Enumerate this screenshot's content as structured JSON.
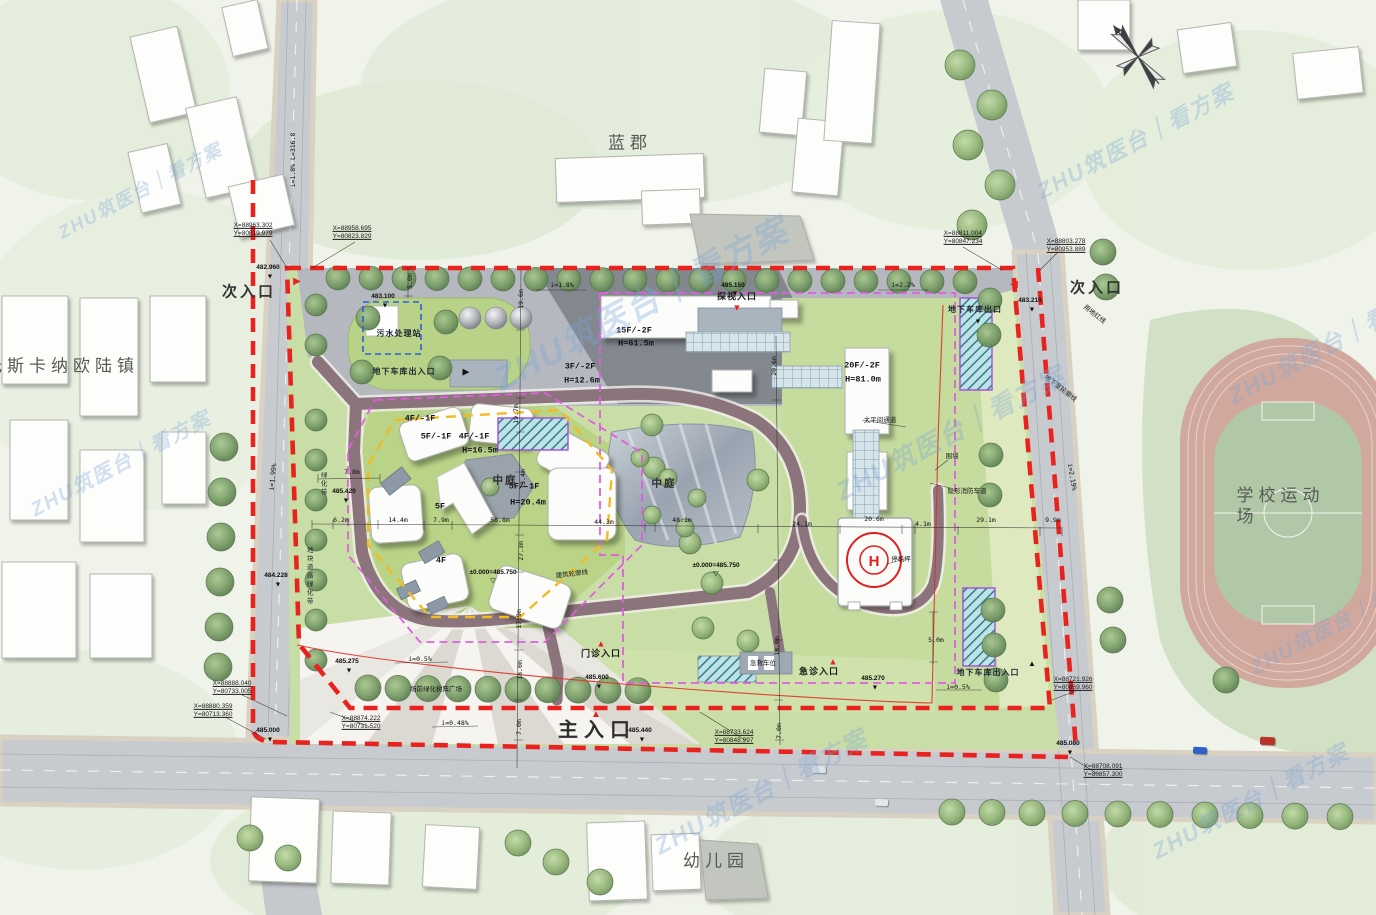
{
  "plan_title": "医院总平面图",
  "colors": {
    "red_line": "#e8231f",
    "magenta_line": "#df5fdf",
    "yellow_line": "#f2bb22",
    "blue_line": "#2b5fd9",
    "road": "#c7cace",
    "lawn": "#c9dda6",
    "ring_road": "#8b747b",
    "track": "#d0a89e",
    "helipad_mark": "#e02020",
    "watermark": "#76a6d6"
  },
  "watermark": {
    "text": "ZHU筑医台｜看方案"
  },
  "north_arrow": {
    "present": true
  },
  "labels": [
    {
      "n": "district-lanjun",
      "t": "蓝郡",
      "x": 630,
      "y": 143,
      "c": "area"
    },
    {
      "n": "district-tuscany",
      "t": "托斯卡纳欧陆镇",
      "x": 62,
      "y": 366,
      "c": "area"
    },
    {
      "n": "district-school-field",
      "t": "学校运动场",
      "x": 1283,
      "y": 506,
      "c": "area"
    },
    {
      "n": "district-kindergarten",
      "t": "幼儿园",
      "x": 716,
      "y": 861,
      "c": "area"
    },
    {
      "n": "entrance-secondary-west",
      "t": "次入口",
      "x": 249,
      "y": 293,
      "c": "entr"
    },
    {
      "n": "entrance-secondary-east",
      "t": "次入口",
      "x": 1097,
      "y": 289,
      "c": "entr"
    },
    {
      "n": "entrance-main",
      "t": "主入口",
      "x": 597,
      "y": 731,
      "c": "entr-main"
    },
    {
      "n": "entrance-visit",
      "t": "探视入口",
      "x": 737,
      "y": 297,
      "c": "gate"
    },
    {
      "n": "entrance-outpatient",
      "t": "门诊入口",
      "x": 601,
      "y": 654,
      "c": "gate"
    },
    {
      "n": "entrance-emergency",
      "t": "急诊入口",
      "x": 819,
      "y": 672,
      "c": "gate"
    },
    {
      "n": "ambulance-bay",
      "t": "急救车位",
      "x": 763,
      "y": 664,
      "c": "note"
    },
    {
      "n": "coord-1",
      "t": "X=88963.302\nY=80819.979",
      "x": 253,
      "y": 230,
      "c": "coord"
    },
    {
      "n": "coord-2",
      "t": "X=88958.695\nY=80823.829",
      "x": 352,
      "y": 233,
      "c": "coord"
    },
    {
      "n": "coord-3",
      "t": "X=88811.004\nY=80847.234",
      "x": 963,
      "y": 238,
      "c": "coord"
    },
    {
      "n": "coord-4",
      "t": "X=88803.278\nY=80953.889",
      "x": 1066,
      "y": 246,
      "c": "coord"
    },
    {
      "n": "coord-5",
      "t": "X=88888.040\nY=80733.005",
      "x": 232,
      "y": 688,
      "c": "coord"
    },
    {
      "n": "coord-6",
      "t": "X=88880.359\nY=80713.360",
      "x": 213,
      "y": 711,
      "c": "coord"
    },
    {
      "n": "coord-7",
      "t": "X=88874.222\nY=80731.520",
      "x": 361,
      "y": 723,
      "c": "coord"
    },
    {
      "n": "coord-8",
      "t": "X=88733.624\nY=80848.997",
      "x": 734,
      "y": 737,
      "c": "coord"
    },
    {
      "n": "coord-9",
      "t": "X=88721.926\nY=80869.960",
      "x": 1073,
      "y": 684,
      "c": "coord"
    },
    {
      "n": "coord-10",
      "t": "X=88708.091\nY=80857.300",
      "x": 1103,
      "y": 771,
      "c": "coord"
    },
    {
      "n": "level-1",
      "t": "482.960",
      "x": 268,
      "y": 268,
      "c": "lvl"
    },
    {
      "n": "level-2",
      "t": "483.100",
      "x": 383,
      "y": 297,
      "c": "lvl"
    },
    {
      "n": "level-3",
      "t": "485.150",
      "x": 733,
      "y": 286,
      "c": "lvl"
    },
    {
      "n": "level-4",
      "t": "483.210",
      "x": 1030,
      "y": 301,
      "c": "lvl"
    },
    {
      "n": "level-5",
      "t": "485.420",
      "x": 344,
      "y": 492,
      "c": "lvl"
    },
    {
      "n": "level-6",
      "t": "484.228",
      "x": 276,
      "y": 576,
      "c": "lvl"
    },
    {
      "n": "level-7",
      "t": "485.275",
      "x": 347,
      "y": 662,
      "c": "lvl"
    },
    {
      "n": "level-8",
      "t": "485.600",
      "x": 597,
      "y": 678,
      "c": "lvl"
    },
    {
      "n": "level-9",
      "t": "485.440",
      "x": 640,
      "y": 731,
      "c": "lvl"
    },
    {
      "n": "level-10",
      "t": "485.270",
      "x": 873,
      "y": 679,
      "c": "lvl"
    },
    {
      "n": "level-11",
      "t": "485.080",
      "x": 1068,
      "y": 744,
      "c": "lvl"
    },
    {
      "n": "level-12",
      "t": "485.000",
      "x": 268,
      "y": 731,
      "c": "lvl"
    },
    {
      "n": "level-zero-1",
      "t": "±0.000=485.750",
      "x": 493,
      "y": 573,
      "c": "lvl"
    },
    {
      "n": "level-zero-2",
      "t": "±0.000=485.750",
      "x": 716,
      "y": 566,
      "c": "lvl"
    },
    {
      "n": "sewage-station",
      "t": "污水处理站",
      "x": 399,
      "y": 334,
      "c": "bldg"
    },
    {
      "n": "garage-entry-west",
      "t": "地下车库出入口",
      "x": 404,
      "y": 372,
      "c": "bldg"
    },
    {
      "n": "garage-exit-northeast",
      "t": "地下车库出口",
      "x": 975,
      "y": 310,
      "c": "bldg"
    },
    {
      "n": "garage-entry-southeast",
      "t": "地下车库出入口",
      "x": 988,
      "y": 673,
      "c": "bldg"
    },
    {
      "n": "bldg-15f",
      "t": "15F/-2F",
      "x": 634,
      "y": 331,
      "c": "fl"
    },
    {
      "n": "bldg-15f-h",
      "t": "H=61.5m",
      "x": 636,
      "y": 344,
      "c": "fl"
    },
    {
      "n": "bldg-3f",
      "t": "3F/-2F",
      "x": 580,
      "y": 367,
      "c": "fl"
    },
    {
      "n": "bldg-3f-h",
      "t": "H=12.6m",
      "x": 582,
      "y": 381,
      "c": "fl"
    },
    {
      "n": "bldg-20f",
      "t": "20F/-2F",
      "x": 862,
      "y": 366,
      "c": "fl"
    },
    {
      "n": "bldg-20f-h",
      "t": "H=81.0m",
      "x": 863,
      "y": 380,
      "c": "fl"
    },
    {
      "n": "bldg-4f-a",
      "t": "4F/-1F",
      "x": 420,
      "y": 419,
      "c": "fl"
    },
    {
      "n": "bldg-5f-a",
      "t": "5F/-1F",
      "x": 436,
      "y": 437,
      "c": "fl"
    },
    {
      "n": "bldg-4f-b",
      "t": "4F/-1F",
      "x": 474,
      "y": 437,
      "c": "fl"
    },
    {
      "n": "bldg-4f-b-h",
      "t": "H=16.5m",
      "x": 480,
      "y": 451,
      "c": "fl"
    },
    {
      "n": "bldg-5f-b",
      "t": "5F/-1F",
      "x": 524,
      "y": 487,
      "c": "fl"
    },
    {
      "n": "bldg-5f-b-h",
      "t": "H=20.4m",
      "x": 528,
      "y": 503,
      "c": "fl"
    },
    {
      "n": "bldg-5f-mark",
      "t": "5F",
      "x": 440,
      "y": 507,
      "c": "fl"
    },
    {
      "n": "bldg-4f-mark",
      "t": "4F",
      "x": 441,
      "y": 561,
      "c": "fl"
    },
    {
      "n": "courtyard-west",
      "t": "中庭",
      "x": 505,
      "y": 481,
      "c": "court"
    },
    {
      "n": "courtyard-east",
      "t": "中庭",
      "x": 664,
      "y": 484,
      "c": "court"
    },
    {
      "n": "helipad-note",
      "t": "停机坪",
      "x": 901,
      "y": 560,
      "c": "note"
    },
    {
      "n": "morgue-passage",
      "t": "太平间通道",
      "x": 880,
      "y": 421,
      "c": "note"
    },
    {
      "n": "building-outline-note",
      "t": "建筑轮廓线",
      "x": 572,
      "y": 575,
      "c": "note",
      "r": -7
    },
    {
      "n": "site-redline-note",
      "t": "用地红线",
      "x": 1094,
      "y": 315,
      "c": "note",
      "r": 38
    },
    {
      "n": "basement-outline-note",
      "t": "地下室轮廓线",
      "x": 1060,
      "y": 389,
      "c": "note",
      "r": 38
    },
    {
      "n": "hidden-fire-lane",
      "t": "隐形消防车道",
      "x": 967,
      "y": 492,
      "c": "note"
    },
    {
      "n": "wall-note",
      "t": "围墙",
      "x": 952,
      "y": 457,
      "c": "note"
    },
    {
      "n": "roadside-green-belt",
      "t": "地块道路绿化带",
      "x": 308,
      "y": 576,
      "c": "vtext"
    },
    {
      "n": "green-belt",
      "t": "绿化带",
      "x": 322,
      "y": 484,
      "c": "vtext"
    },
    {
      "n": "front-green-note",
      "t": "场前绿化树阵广场",
      "x": 436,
      "y": 690,
      "c": "note"
    },
    {
      "n": "slope-road-west",
      "t": "i=1.8% L=316.8",
      "x": 293,
      "y": 160,
      "c": "dim",
      "r": -90
    },
    {
      "n": "slope-1",
      "t": "i=1.8%",
      "x": 562,
      "y": 285,
      "c": "dim"
    },
    {
      "n": "slope-2",
      "t": "i=2.2%",
      "x": 903,
      "y": 285,
      "c": "dim"
    },
    {
      "n": "slope-3",
      "t": "i=1.99%",
      "x": 273,
      "y": 477,
      "c": "dim",
      "r": -84
    },
    {
      "n": "slope-4",
      "t": "i=2.19%",
      "x": 1072,
      "y": 477,
      "c": "dim",
      "r": 80
    },
    {
      "n": "slope-5",
      "t": "i=0.5%",
      "x": 420,
      "y": 659,
      "c": "dim"
    },
    {
      "n": "slope-6",
      "t": "i=0.5%",
      "x": 958,
      "y": 687,
      "c": "dim"
    },
    {
      "n": "slope-7",
      "t": "i=0.48%",
      "x": 455,
      "y": 723,
      "c": "dim"
    },
    {
      "n": "dim-1",
      "t": "6.2m",
      "x": 341,
      "y": 520,
      "c": "dim"
    },
    {
      "n": "dim-2",
      "t": "14.4m",
      "x": 398,
      "y": 520,
      "c": "dim"
    },
    {
      "n": "dim-3",
      "t": "7.9m",
      "x": 441,
      "y": 520,
      "c": "dim"
    },
    {
      "n": "dim-4",
      "t": "7.8m",
      "x": 352,
      "y": 472,
      "c": "dim"
    },
    {
      "n": "dim-5",
      "t": "58.8m",
      "x": 500,
      "y": 520,
      "c": "dim"
    },
    {
      "n": "dim-6",
      "t": "44.3m",
      "x": 604,
      "y": 522,
      "c": "dim"
    },
    {
      "n": "dim-7",
      "t": "48.1m",
      "x": 682,
      "y": 520,
      "c": "dim"
    },
    {
      "n": "dim-8",
      "t": "24.1m",
      "x": 802,
      "y": 524,
      "c": "dim"
    },
    {
      "n": "dim-9",
      "t": "20.6m",
      "x": 874,
      "y": 519,
      "c": "dim"
    },
    {
      "n": "dim-10",
      "t": "4.1m",
      "x": 923,
      "y": 524,
      "c": "dim"
    },
    {
      "n": "dim-11",
      "t": "29.1m",
      "x": 986,
      "y": 520,
      "c": "dim"
    },
    {
      "n": "dim-12",
      "t": "9.9m",
      "x": 1053,
      "y": 520,
      "c": "dim"
    },
    {
      "n": "dim-13",
      "t": "5.0m",
      "x": 410,
      "y": 281,
      "c": "dim",
      "r": -90
    },
    {
      "n": "dim-14",
      "t": "19.6m",
      "x": 521,
      "y": 299,
      "c": "dim",
      "r": -90
    },
    {
      "n": "dim-15",
      "t": "19.7m",
      "x": 516,
      "y": 414,
      "c": "dim",
      "r": -90
    },
    {
      "n": "dim-16",
      "t": "13.4m",
      "x": 523,
      "y": 479,
      "c": "dim",
      "r": -90
    },
    {
      "n": "dim-17",
      "t": "27.3m",
      "x": 521,
      "y": 551,
      "c": "dim",
      "r": -90
    },
    {
      "n": "dim-18",
      "t": "17.9m",
      "x": 519,
      "y": 619,
      "c": "dim",
      "r": -90
    },
    {
      "n": "dim-19",
      "t": "18.0m",
      "x": 520,
      "y": 670,
      "c": "dim",
      "r": -90
    },
    {
      "n": "dim-20",
      "t": "7.0m",
      "x": 519,
      "y": 727,
      "c": "dim",
      "r": -90
    },
    {
      "n": "dim-21",
      "t": "20.6m",
      "x": 774,
      "y": 366,
      "c": "dim",
      "r": -90
    },
    {
      "n": "dim-22",
      "t": "18.0m",
      "x": 777,
      "y": 646,
      "c": "dim",
      "r": -90
    },
    {
      "n": "dim-23",
      "t": "7.0m",
      "x": 779,
      "y": 731,
      "c": "dim",
      "r": -90
    },
    {
      "n": "dim-24",
      "t": "5.0m",
      "x": 936,
      "y": 640,
      "c": "dim"
    }
  ],
  "marks": [
    {
      "x": 270,
      "y": 277,
      "ch": "▼",
      "col": "#111",
      "s": 7
    },
    {
      "x": 385,
      "y": 306,
      "ch": "▼",
      "col": "#111",
      "s": 7
    },
    {
      "x": 735,
      "y": 294,
      "ch": "▼",
      "col": "#111",
      "s": 7
    },
    {
      "x": 1032,
      "y": 310,
      "ch": "▼",
      "col": "#111",
      "s": 7
    },
    {
      "x": 346,
      "y": 501,
      "ch": "▼",
      "col": "#111",
      "s": 7
    },
    {
      "x": 278,
      "y": 585,
      "ch": "▼",
      "col": "#111",
      "s": 7
    },
    {
      "x": 349,
      "y": 671,
      "ch": "▼",
      "col": "#111",
      "s": 7
    },
    {
      "x": 599,
      "y": 687,
      "ch": "▼",
      "col": "#111",
      "s": 7
    },
    {
      "x": 642,
      "y": 740,
      "ch": "▼",
      "col": "#111",
      "s": 7
    },
    {
      "x": 875,
      "y": 688,
      "ch": "▼",
      "col": "#111",
      "s": 7
    },
    {
      "x": 1070,
      "y": 753,
      "ch": "▼",
      "col": "#111",
      "s": 7
    },
    {
      "x": 270,
      "y": 740,
      "ch": "▼",
      "col": "#111",
      "s": 7
    },
    {
      "x": 978,
      "y": 322,
      "ch": "▼",
      "col": "#111",
      "s": 7
    },
    {
      "x": 493,
      "y": 581,
      "ch": "▽",
      "col": "#111",
      "s": 7
    },
    {
      "x": 716,
      "y": 574,
      "ch": "▽",
      "col": "#111",
      "s": 7
    },
    {
      "x": 297,
      "y": 282,
      "ch": "▶",
      "col": "#e8231f",
      "s": 10
    },
    {
      "x": 1014,
      "y": 285,
      "ch": "◀",
      "col": "#e8231f",
      "s": 10
    },
    {
      "x": 737,
      "y": 308,
      "ch": "▼",
      "col": "#e8231f",
      "s": 9
    },
    {
      "x": 596,
      "y": 715,
      "ch": "▲",
      "col": "#e8231f",
      "s": 10
    },
    {
      "x": 601,
      "y": 644,
      "ch": "▲",
      "col": "#e8231f",
      "s": 9
    },
    {
      "x": 833,
      "y": 662,
      "ch": "▲",
      "col": "#e8231f",
      "s": 9
    },
    {
      "x": 466,
      "y": 372,
      "ch": "▶",
      "col": "#111",
      "s": 9
    },
    {
      "x": 1032,
      "y": 664,
      "ch": "▲",
      "col": "#111",
      "s": 8
    }
  ],
  "cars": [
    {
      "x": 1193,
      "y": 747,
      "w": 14,
      "h": 7,
      "col": "#2f62c9",
      "r": 3
    },
    {
      "x": 1260,
      "y": 737,
      "w": 15,
      "h": 8,
      "col": "#b8332a",
      "r": 2
    },
    {
      "x": 812,
      "y": 766,
      "w": 14,
      "h": 7,
      "col": "#dfe2e6",
      "r": 1
    },
    {
      "x": 875,
      "y": 799,
      "w": 13,
      "h": 7,
      "col": "#e4e6e9",
      "r": 3
    }
  ],
  "watermarks": [
    {
      "x": 140,
      "y": 190,
      "s": 18,
      "r": -28
    },
    {
      "x": 120,
      "y": 462,
      "s": 20,
      "r": -28
    },
    {
      "x": 640,
      "y": 302,
      "s": 34,
      "r": -28
    },
    {
      "x": 950,
      "y": 432,
      "s": 26,
      "r": -28
    },
    {
      "x": 1330,
      "y": 342,
      "s": 23,
      "r": -28
    },
    {
      "x": 1135,
      "y": 140,
      "s": 22,
      "r": -28
    },
    {
      "x": 760,
      "y": 790,
      "s": 24,
      "r": -28
    },
    {
      "x": 1250,
      "y": 800,
      "s": 22,
      "r": -28
    },
    {
      "x": 1340,
      "y": 620,
      "s": 20,
      "r": -28
    }
  ]
}
